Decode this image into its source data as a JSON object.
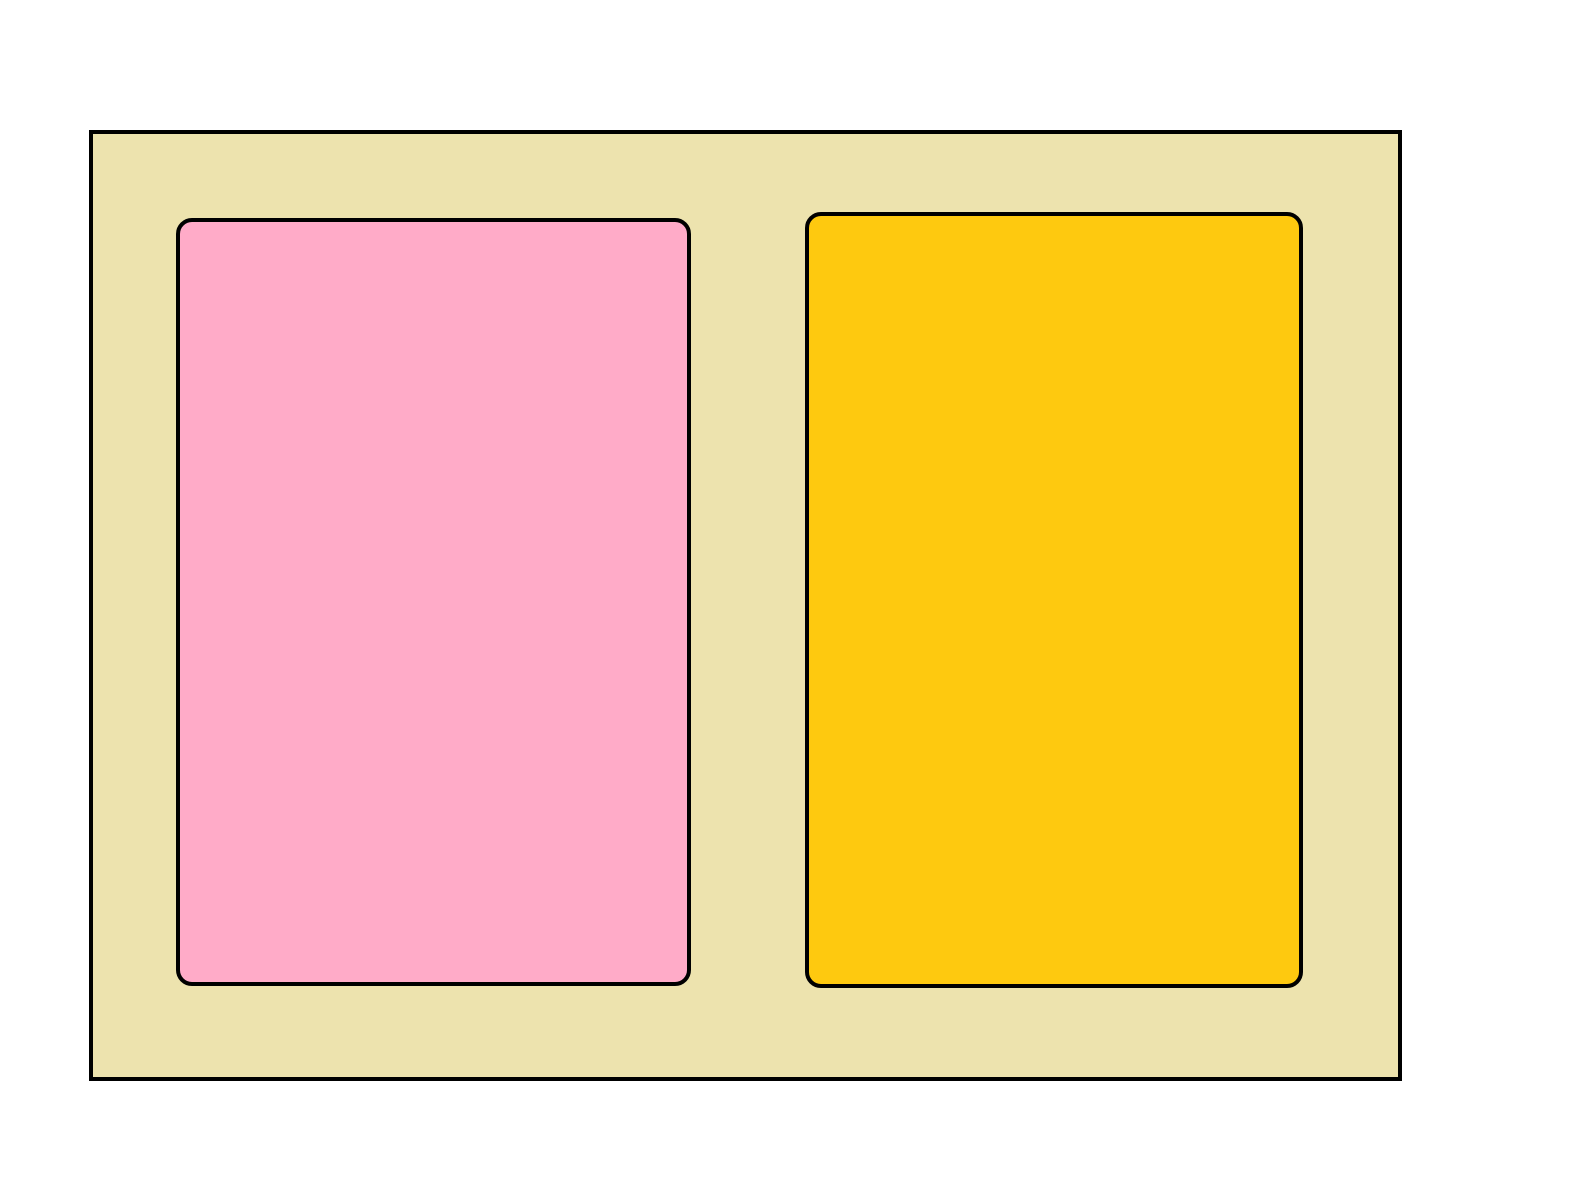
{
  "drawing": {
    "description": "Simple shape drawing: outer bordered rectangle containing two rounded rectangles",
    "background_color": "#ffffff",
    "stroke_color": "#000000",
    "shapes": [
      {
        "id": "outer-rectangle",
        "type": "rectangle",
        "fill": "#EDE3AE",
        "stroke": "#000000"
      },
      {
        "id": "left-rounded-rectangle",
        "type": "rounded-rectangle",
        "fill": "#FFABC8",
        "stroke": "#000000"
      },
      {
        "id": "right-rounded-rectangle",
        "type": "rounded-rectangle",
        "fill": "#FEC90F",
        "stroke": "#000000"
      }
    ]
  }
}
